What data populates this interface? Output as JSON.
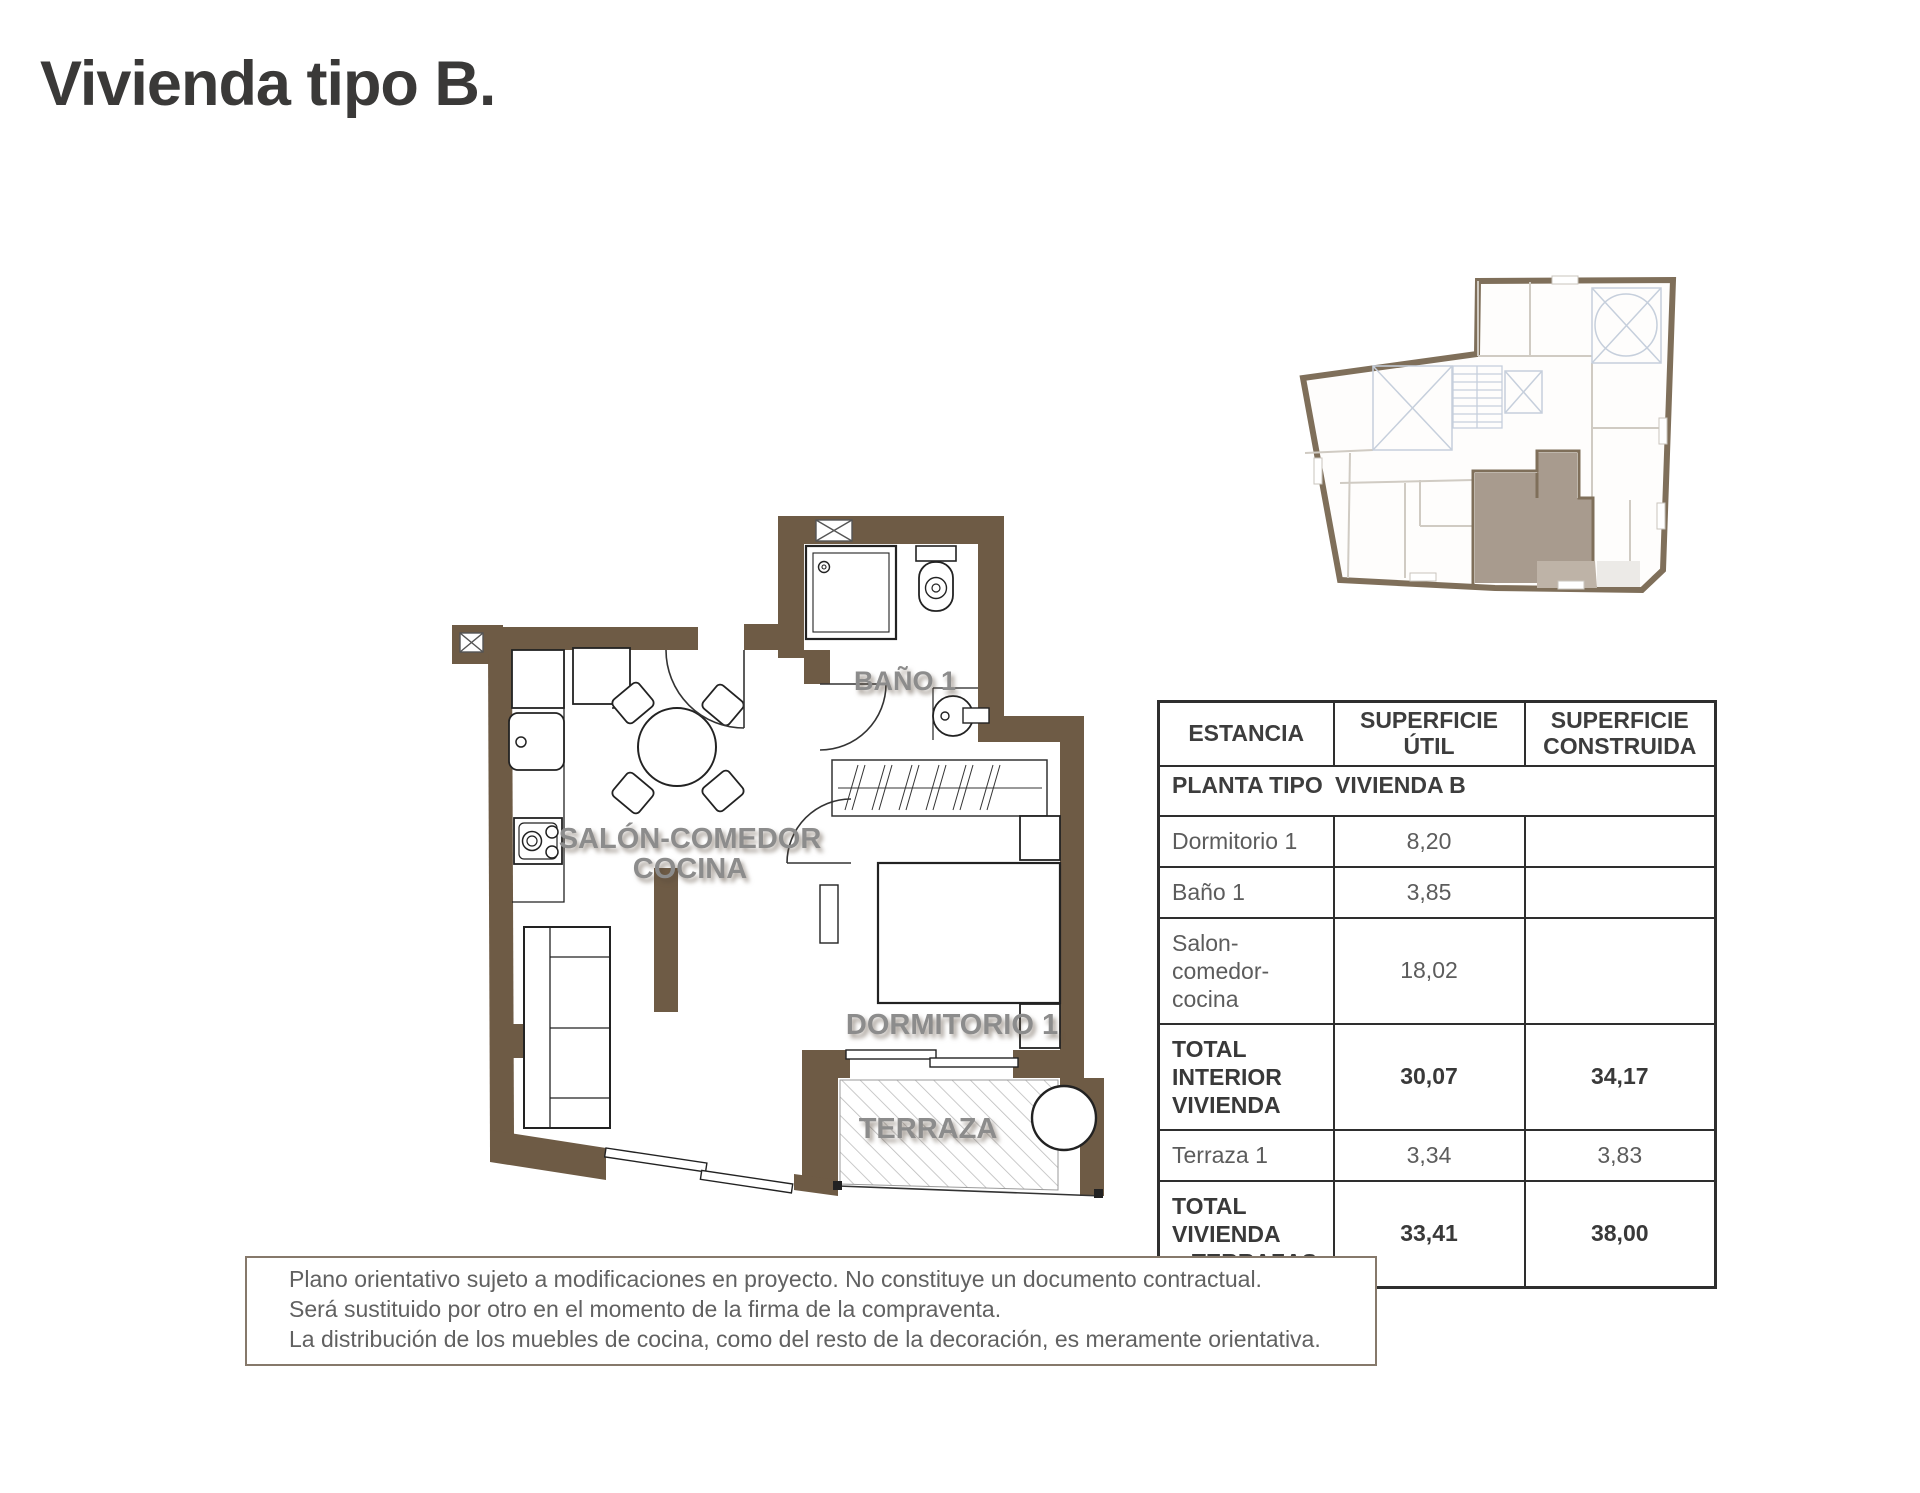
{
  "page": {
    "title": "Vivienda tipo B."
  },
  "floor_plan": {
    "wall_color": "#6e5b45",
    "labels": {
      "bano": "BAÑO 1",
      "salon_line1": "SALÓN-COMEDOR",
      "salon_line2": "COCINA",
      "dormitorio": "DORMITORIO 1",
      "terraza": "TERRAZA"
    }
  },
  "key_plan": {
    "wall_color": "#7f6f5a",
    "highlight_color": "#a89b8e",
    "terrace_highlight_color": "#beb3a7",
    "patio_hatch_color": "#c6cfdc"
  },
  "table": {
    "headers": [
      "ESTANCIA",
      "SUPERFICIE\nÚTIL",
      "SUPERFICIE\nCONSTRUIDA"
    ],
    "subheader": {
      "label": "PLANTA TIPO",
      "value": "VIVIENDA B"
    },
    "rows": [
      {
        "name": "Dormitorio 1",
        "util": "8,20",
        "construida": "",
        "bold": false
      },
      {
        "name": "Baño 1",
        "util": "3,85",
        "construida": "",
        "bold": false
      },
      {
        "name": "Salon-\ncomedor-\ncocina",
        "util": "18,02",
        "construida": "",
        "bold": false
      },
      {
        "name": "TOTAL INTERIOR\nVIVIENDA",
        "util": "30,07",
        "construida": "34,17",
        "bold": true
      },
      {
        "name": "Terraza 1",
        "util": "3,34",
        "construida": "3,83",
        "bold": false
      },
      {
        "name": "TOTAL VIVIENDA\n+ TERRAZAS",
        "util": "33,41",
        "construida": "38,00",
        "bold": true
      }
    ]
  },
  "disclaimer": {
    "lines": [
      "Plano orientativo sujeto a modificaciones en proyecto. No constituye un documento contractual.",
      "Será sustituido por otro en el momento de la firma de la compraventa.",
      "La distribución de los muebles de cocina, como del resto de la decoración, es meramente orientativa."
    ]
  }
}
